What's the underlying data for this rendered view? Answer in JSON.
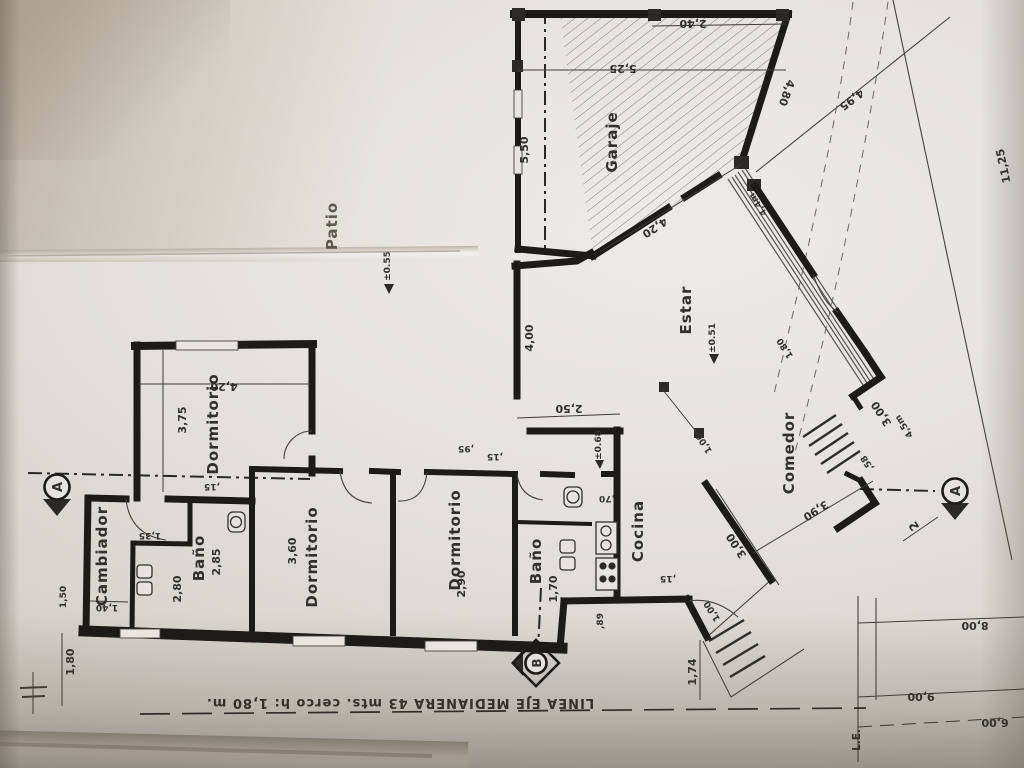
{
  "rooms": {
    "garaje": "Garaje",
    "patio": "Patio",
    "estar": "Estar",
    "comedor": "Comedor",
    "cocina": "Cocina",
    "bano1": "Baño",
    "bano2": "Baño",
    "dormitorio1": "Dormitorio",
    "dormitorio2": "Dormitorio",
    "dormitorio3": "Dormitorio",
    "cambiador": "Cambiador"
  },
  "levels": {
    "patio": "±0.55",
    "estar": "±0.51",
    "hall": "±0.68"
  },
  "markers": {
    "section_a": "A",
    "section_b": "B",
    "note_2": "2",
    "linea_edificacion": "L.E."
  },
  "boundary_text": "LINEA EJE MEDIANERA  43 mts.   cerco  h: 1,80 m.",
  "dims": {
    "garage_bay_top": "2,40",
    "garage_width": "5,25",
    "garage_bay_left": "5,50",
    "garage_side": "4,80",
    "lot_diagonal": "4,95",
    "lot_right_edge": "11,25",
    "estar_edge": "4,20",
    "hall_length": "4,00",
    "hall_width": "2,50",
    "dorm1_width": "3,75",
    "dorm1_length": "4,20",
    "dorm1_jamb": ",15",
    "cambiador_width": "1,40",
    "bano1_niche": "1,35",
    "bano1_length": "2,80",
    "bano1_depth": "2,85",
    "dorm2_width": "3,60",
    "dorm3_width": "2,90",
    "dorm3_jamb_a": ",95",
    "dorm3_jamb_b": ",15",
    "bano2_width": "1,70",
    "cocina_pass": ",70",
    "entry_jamb": ",15",
    "entry_door": "1,00",
    "entry_depth": "1,74",
    "entry_side": ",89",
    "comedor_width": "3,90",
    "comedor_length": "3,00",
    "gallery_post": "1,06",
    "porch_jamb": ",58",
    "porch_door": "1,80",
    "porch_length": "3,00",
    "ramp_a": "4,4m",
    "ramp_b": "4,5m",
    "side_passage": "1,50",
    "yard_height": "1,80",
    "lot_bottom_a": "8,00",
    "lot_bottom_b": "9,00",
    "lot_bottom_c": "6,00"
  }
}
